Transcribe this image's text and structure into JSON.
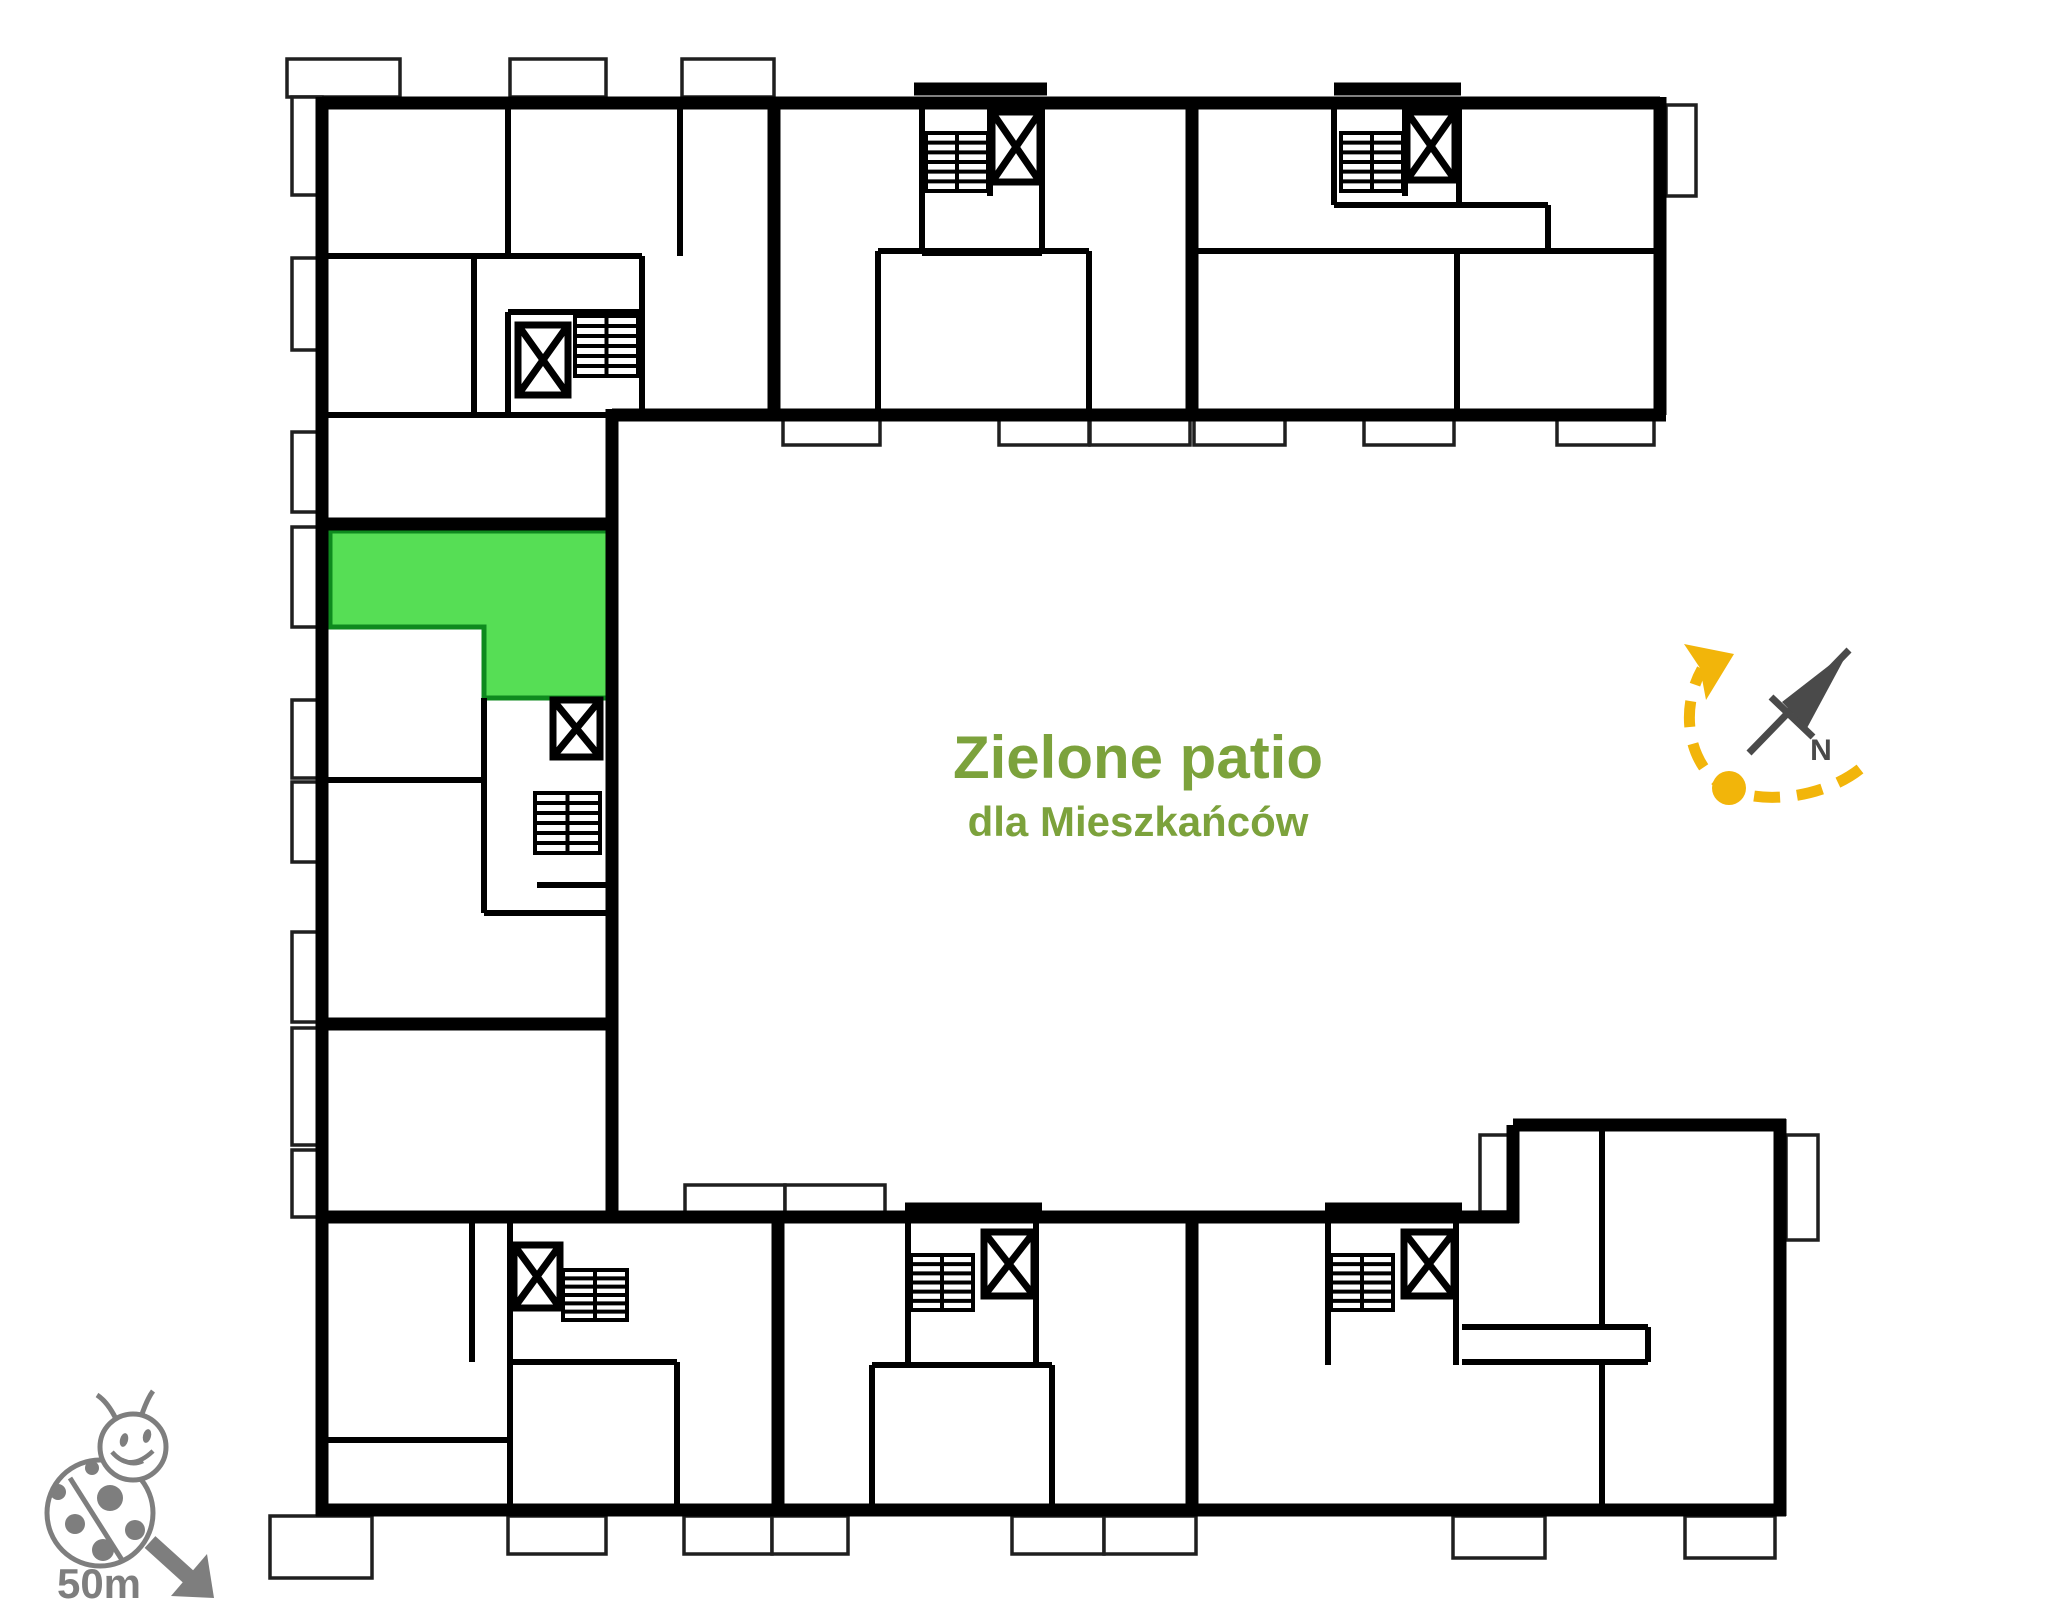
{
  "patio": {
    "line1": "Zielone patio",
    "line2": "dla Mieszkańców"
  },
  "compass": {
    "n_label": "N"
  },
  "scale": {
    "label": "50m"
  },
  "colors": {
    "wall": "#000000",
    "unit_highlight": "#56DE55",
    "unit_highlight_stroke": "#0e8a1e",
    "patio_text": "#7CA23C",
    "route_yellow": "#F2B50A",
    "needle_gray": "#4A4A4A",
    "ladybug_gray": "#7E7E7E"
  },
  "floorplan": {
    "viewbox": "0 0 2048 1623",
    "walls_thick": [
      "M322,103 H1660",
      "M1660,97 V415",
      "M612,415 H1666",
      "M612,409 V1223",
      "M606,1217 H1519",
      "M1513,1223 V1125",
      "M1513,1125 H1786",
      "M1780,1119 V1516",
      "M1786,1510 H316",
      "M322,1516 V97",
      "M774,103 V415",
      "M1192,103 V415",
      "M778,1217 V1510",
      "M1192,1217 V1510",
      "M914,89 H1047",
      "M1334,89 H1461",
      "M905,1209 H1042",
      "M1325,1209 H1462",
      "M322,524 H612",
      "M322,1024 H612",
      "M322,1217 H612"
    ],
    "walls_medium": [
      "M322,415 H612",
      "M322,256 H642",
      "M508,103 V256",
      "M680,103 V256",
      "M474,256 V415",
      "M642,256 V415",
      "M508,312 H642",
      "M508,312 V415",
      "M922,103 V253",
      "M1042,103 V253",
      "M990,103 V196",
      "M922,253 H1042",
      "M878,251 H1089",
      "M878,251 V409",
      "M1089,251 V409",
      "M1334,103 V205",
      "M1405,103 V196",
      "M1334,205 H1459",
      "M1459,103 V205",
      "M1459,205 H1548",
      "M1548,205 V251",
      "M1192,251 H1660",
      "M1457,251 V409",
      "M322,780 H484",
      "M484,698 V913",
      "M484,913 H612",
      "M537,885 H612",
      "M472,1217 V1362",
      "M510,1217 V1510",
      "M510,1362 H677",
      "M677,1362 V1510",
      "M322,1440 H510",
      "M908,1217 V1365",
      "M1036,1217 V1365",
      "M872,1365 H1052",
      "M872,1365 V1510",
      "M1052,1365 V1510",
      "M1328,1217 V1365",
      "M1456,1217 V1365",
      "M1462,1327 H1648",
      "M1462,1362 H1648",
      "M1648,1327 V1362",
      "M1602,1125 V1327",
      "M1602,1362 V1510"
    ],
    "balconies": [
      [
        287,
        59,
        113,
        38
      ],
      [
        510,
        59,
        96,
        38
      ],
      [
        682,
        59,
        92,
        38
      ],
      [
        292,
        97,
        30,
        98
      ],
      [
        292,
        258,
        30,
        92
      ],
      [
        1666,
        105,
        30,
        91
      ],
      [
        292,
        432,
        30,
        80
      ],
      [
        292,
        527,
        30,
        100
      ],
      [
        292,
        700,
        30,
        78
      ],
      [
        292,
        782,
        30,
        80
      ],
      [
        292,
        932,
        30,
        90
      ],
      [
        292,
        1028,
        30,
        117
      ],
      [
        292,
        1150,
        30,
        67
      ],
      [
        783,
        415,
        97,
        30
      ],
      [
        999,
        415,
        90,
        30
      ],
      [
        1090,
        415,
        100,
        30
      ],
      [
        1194,
        415,
        91,
        30
      ],
      [
        1364,
        415,
        90,
        30
      ],
      [
        1557,
        415,
        97,
        30
      ],
      [
        685,
        1185,
        100,
        32
      ],
      [
        785,
        1185,
        100,
        32
      ],
      [
        1480,
        1135,
        33,
        77
      ],
      [
        1786,
        1135,
        32,
        105
      ],
      [
        270,
        1516,
        102,
        62
      ],
      [
        508,
        1516,
        98,
        38
      ],
      [
        684,
        1516,
        88,
        38
      ],
      [
        772,
        1516,
        76,
        38
      ],
      [
        1012,
        1516,
        92,
        38
      ],
      [
        1104,
        1516,
        92,
        38
      ],
      [
        1453,
        1516,
        92,
        42
      ],
      [
        1685,
        1516,
        90,
        42
      ]
    ],
    "unit_highlight_points": "330,531 612,531 612,698 484,698 484,627 330,627",
    "elevators": [
      [
        518,
        325,
        50,
        70
      ],
      [
        992,
        112,
        48,
        70
      ],
      [
        1407,
        112,
        48,
        68
      ],
      [
        553,
        700,
        47,
        57
      ],
      [
        514,
        1245,
        46,
        63
      ],
      [
        984,
        1232,
        50,
        64
      ],
      [
        1404,
        1232,
        50,
        64
      ]
    ],
    "stairs": [
      {
        "box": [
          575,
          316,
          63,
          60
        ]
      },
      {
        "box": [
          926,
          133,
          62,
          58
        ]
      },
      {
        "box": [
          1341,
          133,
          62,
          58
        ]
      },
      {
        "box": [
          535,
          793,
          65,
          60
        ]
      },
      {
        "box": [
          563,
          1270,
          64,
          50
        ]
      },
      {
        "box": [
          911,
          1255,
          62,
          55
        ]
      },
      {
        "box": [
          1331,
          1255,
          62,
          55
        ]
      }
    ]
  }
}
